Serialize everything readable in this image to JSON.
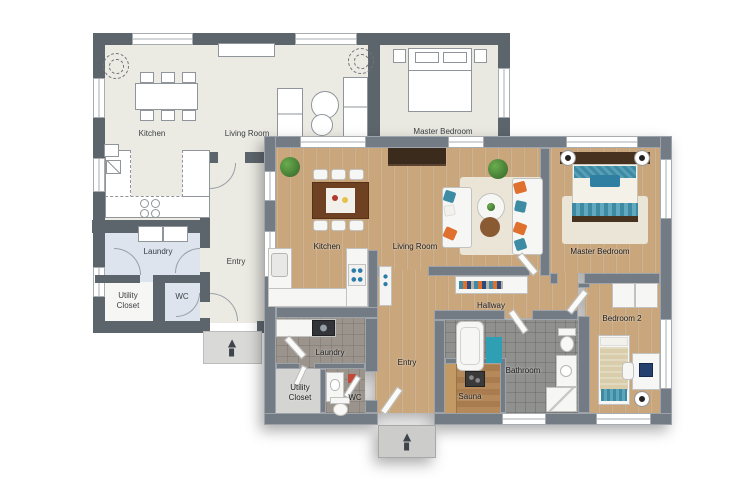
{
  "plan_2d": {
    "labels": {
      "kitchen": "Kitchen",
      "living_room": "Living Room",
      "master_bedroom": "Master Bedroom",
      "laundry": "Laundry",
      "entry": "Entry",
      "utility_closet": "Utility\nCloset",
      "wc": "WC"
    }
  },
  "plan_3d": {
    "labels": {
      "kitchen": "Kitchen",
      "living_room": "Living Room",
      "master_bedroom": "Master Bedroom",
      "hallway": "Hallway",
      "bedroom_2": "Bedroom 2",
      "bathroom": "Bathroom",
      "sauna": "Sauna",
      "laundry": "Laundry",
      "entry": "Entry",
      "utility_closet": "Utility\nCloset",
      "wc": "WC"
    }
  },
  "icons": {
    "north_arrow": "▲"
  },
  "colors": {
    "wall_2d": "#5c646c",
    "floor_2d": "#ebeae3",
    "wet_room_2d": "#dde4ee",
    "wall_3d": "#737c85",
    "wood_floor": "#c9a67c",
    "tile_floor": "#90908e",
    "accent_teal": "#3d8ca4",
    "accent_orange": "#e0702d",
    "rug": "#eae5d7"
  }
}
